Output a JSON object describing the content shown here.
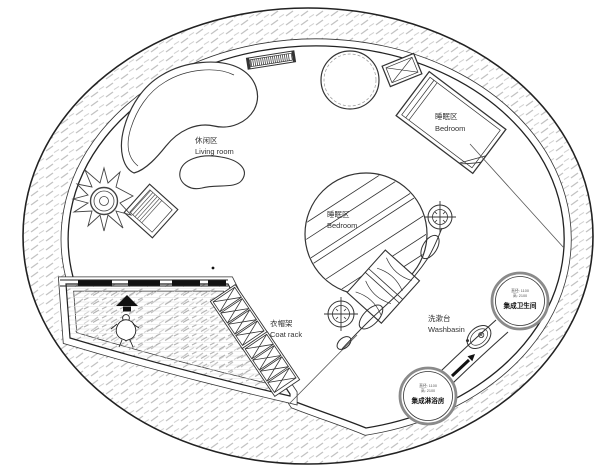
{
  "labels": {
    "living_room": {
      "zh": "休闲区",
      "en": "Living room"
    },
    "bedroom_upper": {
      "zh": "睡眠区",
      "en": "Bedroom"
    },
    "bedroom_center": {
      "zh": "睡眠区",
      "en": "Bedroom"
    },
    "coat_rack": {
      "zh": "衣帽架",
      "en": "Coat rack"
    },
    "washbasin": {
      "zh": "洗漱台",
      "en": "Washbasin"
    },
    "bathroom_pod": {
      "dim_diameter": "直径: 1100",
      "dim_height": "高: 2100",
      "name": "集成卫生间"
    },
    "shower_pod": {
      "dim_diameter": "直径: 1100",
      "dim_height": "高: 2100",
      "name": "集成淋浴房"
    }
  },
  "icons": {
    "entry-arrow": "▲",
    "column-symbol": "⊕"
  },
  "colors": {
    "line": "#222222",
    "wall": "#111111",
    "hatch": "#c2c2c2",
    "pod_ring": "#8a8a8a",
    "background": "#ffffff"
  }
}
